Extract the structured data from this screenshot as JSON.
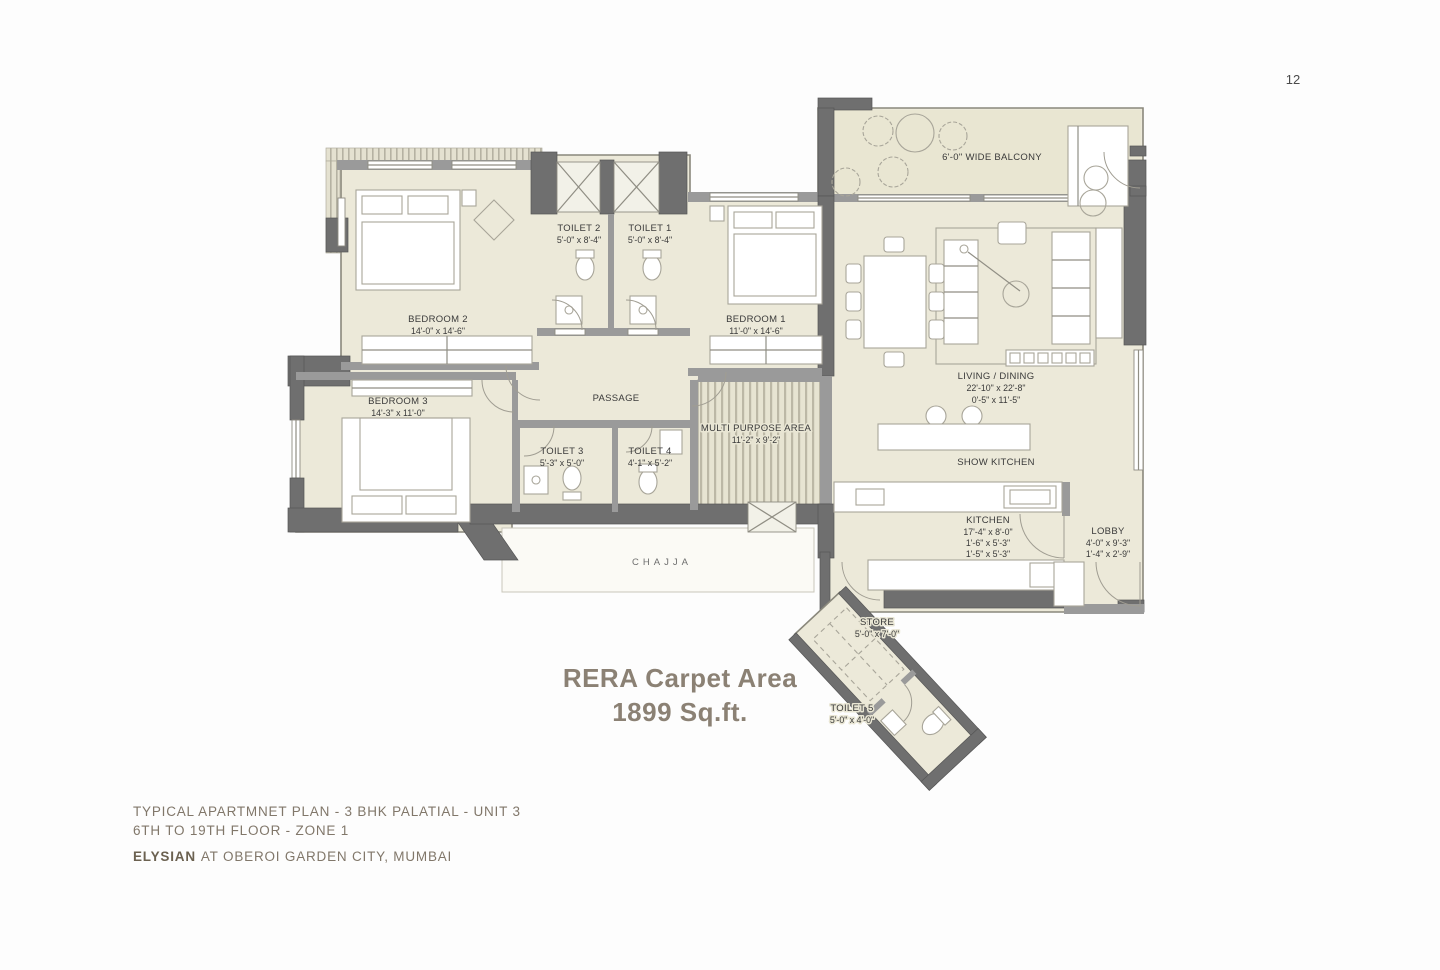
{
  "page": {
    "number": "12"
  },
  "carpet_area": {
    "line1": "RERA Carpet Area",
    "line2": "1899 Sq.ft."
  },
  "title_block": {
    "line1": "TYPICAL APARTMNET PLAN - 3 BHK PALATIAL - UNIT 3",
    "line2": "6TH TO 19TH FLOOR - ZONE 1",
    "brand": "ELYSIAN",
    "brand_suffix": "AT OBEROI GARDEN CITY, MUMBAI"
  },
  "rooms": {
    "balcony": {
      "label": "6'-0\" WIDE BALCONY"
    },
    "bedroom2": {
      "label": "BEDROOM 2",
      "dim": "14'-0\" x 14'-6\""
    },
    "toilet2": {
      "label": "TOILET 2",
      "dim": "5'-0\" x 8'-4\""
    },
    "toilet1": {
      "label": "TOILET 1",
      "dim": "5'-0\" x 8'-4\""
    },
    "bedroom1": {
      "label": "BEDROOM 1",
      "dim": "11'-0\" x 14'-6\""
    },
    "bedroom3": {
      "label": "BEDROOM 3",
      "dim": "14'-3\" x 11'-0\""
    },
    "passage": {
      "label": "PASSAGE"
    },
    "multi_purpose": {
      "label": "MULTI PURPOSE AREA",
      "dim": "11'-2\" x 9'-2\""
    },
    "living_dining": {
      "label": "LIVING / DINING",
      "dim1": "22'-10\" x 22'-8\"",
      "dim2": "0'-5\" x 11'-5\""
    },
    "show_kitchen": {
      "label": "SHOW KITCHEN"
    },
    "toilet3": {
      "label": "TOILET 3",
      "dim": "5'-3\" x 5'-0\""
    },
    "toilet4": {
      "label": "TOILET 4",
      "dim": "4'-1\" x 5'-2\""
    },
    "kitchen": {
      "label": "KITCHEN",
      "dim1": "17'-4\" x 8'-0\"",
      "dim2": "1'-6\" x 5'-3\"",
      "dim3": "1'-5\" x 5'-3\""
    },
    "lobby": {
      "label": "LOBBY",
      "dim1": "4'-0\" x 9'-3\"",
      "dim2": "1'-4\" x 2'-9\""
    },
    "chajja": {
      "label": "CHAJJA"
    },
    "store": {
      "label": "STORE",
      "dim": "5'-0\" x 7'-0\""
    },
    "toilet5": {
      "label": "TOILET 5",
      "dim": "5'-0\" x 4'-0\""
    }
  },
  "colors": {
    "floor": "#ece9d9",
    "wall_dark": "#6f6f6f",
    "accent_text": "#8b8174",
    "footer_text": "#81776a"
  }
}
